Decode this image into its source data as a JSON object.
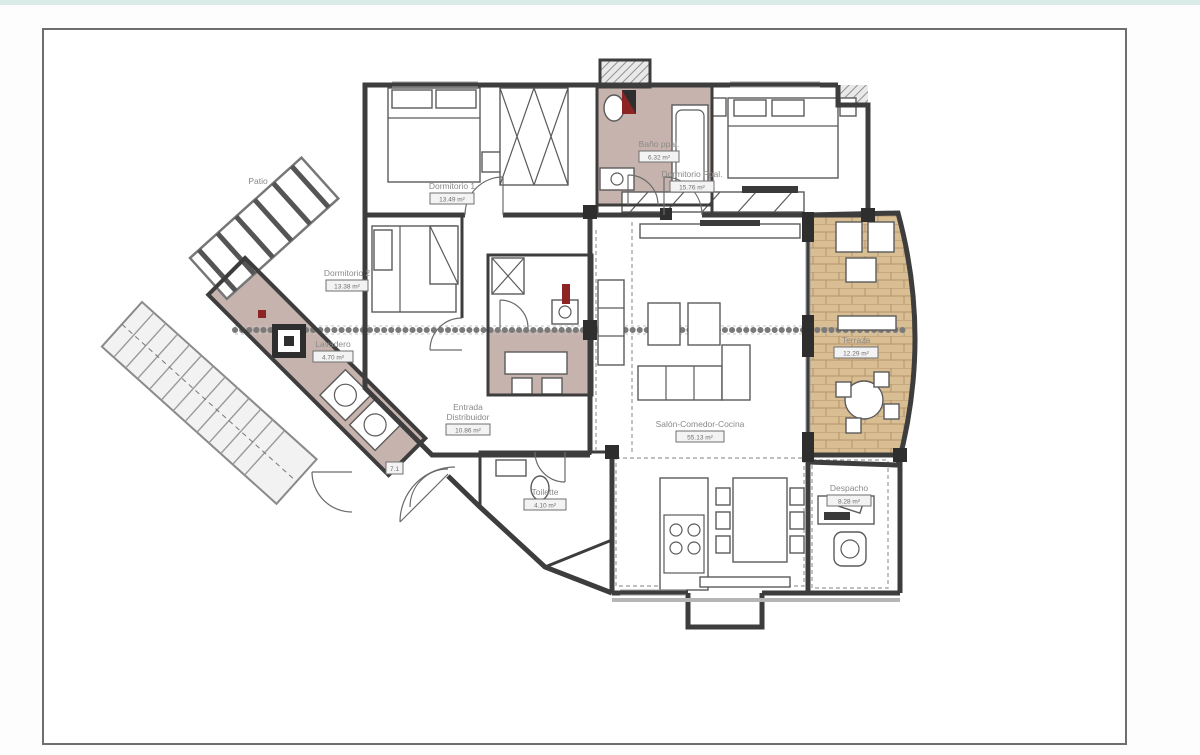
{
  "window": {
    "top_bar_color": "#d9ece8",
    "background": "#ffffff",
    "frame_border_color": "#6e6e6e"
  },
  "floorplan": {
    "patio": {
      "label": "Patio"
    },
    "entry_marker": "7.1",
    "rooms": {
      "dormitorio1": {
        "label": "Dormitorio 1",
        "area": "13.49 m²"
      },
      "dormitorio_ppal": {
        "label": "Dormitorio Ppal.",
        "area": "15.76 m²"
      },
      "bano_ppal": {
        "label": "Baño ppal.",
        "area": "6.32 m²"
      },
      "dormitorio2": {
        "label": "Dormitorio 2",
        "area": "13.38 m²"
      },
      "lavadero": {
        "label": "Lavadero",
        "area": "4.70 m²"
      },
      "entrada": {
        "label_line1": "Entrada",
        "label_line2": "Distribuidor",
        "area": "10.86 m²"
      },
      "salon": {
        "label": "Salón-Comedor-Cocina",
        "area": "55.13 m²"
      },
      "terraza": {
        "label": "Terraza",
        "area": "12.29 m²"
      },
      "toilette": {
        "label": "Toilette",
        "area": "4.10 m²"
      },
      "despacho": {
        "label": "Despacho",
        "area": "8.28 m²"
      }
    },
    "colors": {
      "wall": "#3d3d3d",
      "bath_floor": "#b39a92",
      "terrace_floor": "#d9be94",
      "terrace_grout": "#b2946a",
      "accent_red": "#8c2424",
      "label_text": "#8a8a8a"
    }
  }
}
